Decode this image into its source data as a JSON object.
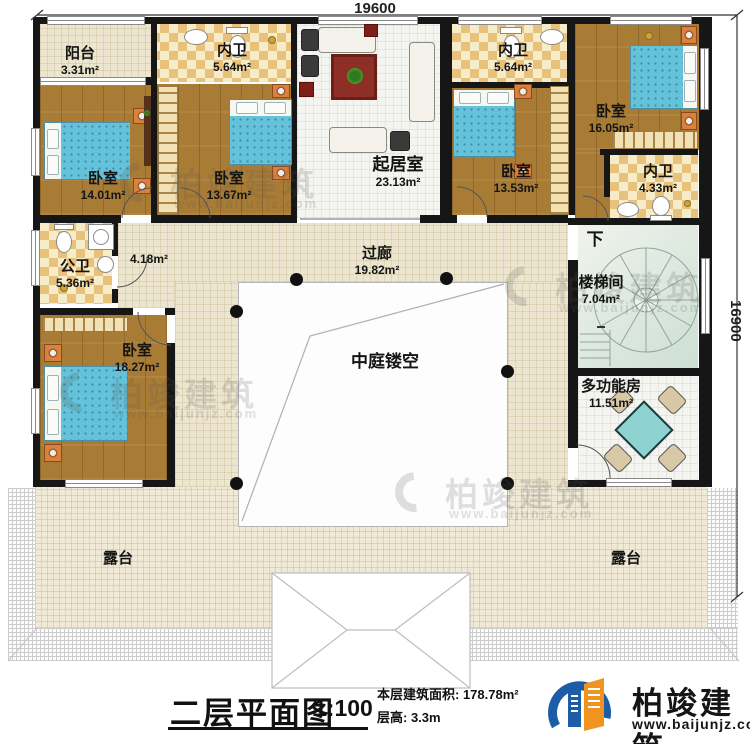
{
  "dimensions": {
    "top": "19600",
    "right": "16900"
  },
  "rooms": [
    {
      "name": "阳台",
      "area": "3.31m²"
    },
    {
      "name": "内卫",
      "area": "5.64m²"
    },
    {
      "name": "起居室",
      "area": "23.13m²"
    },
    {
      "name": "内卫",
      "area": "5.64m²"
    },
    {
      "name": "卧室",
      "area": "16.05m²"
    },
    {
      "name": "卧室",
      "area": "14.01m²"
    },
    {
      "name": "卧室",
      "area": "13.67m²"
    },
    {
      "name": "卧室",
      "area": "13.53m²"
    },
    {
      "name": "内卫",
      "area": "4.33m²"
    },
    {
      "name": "公卫",
      "area": "5.36m²"
    },
    {
      "name": "",
      "area": "4.18m²"
    },
    {
      "name": "过廊",
      "area": "19.82m²"
    },
    {
      "name": "楼梯间",
      "area": "7.04m²"
    },
    {
      "name": "卧室",
      "area": "18.27m²"
    },
    {
      "name": "中庭镂空",
      "area": ""
    },
    {
      "name": "多功能房",
      "area": "11.51m²"
    },
    {
      "name": "露台",
      "area": ""
    },
    {
      "name": "露台",
      "area": ""
    }
  ],
  "stair": {
    "down_label": "下"
  },
  "title": {
    "name": "二层平面图",
    "scale": "1:100",
    "area_line": "本层建筑面积: 178.78m²",
    "height_line": "层高: 3.3m"
  },
  "brand": {
    "name": "柏竣建筑",
    "site": "www.baijunjz.com"
  },
  "watermark": {
    "name": "柏竣建筑",
    "site": "www.baijunjz.com"
  },
  "colors": {
    "wall": "#161616",
    "wood": "#a97c36",
    "corridor": "#ece5cf",
    "terrace": "#efe9d6",
    "bed": "#64c3da",
    "logo_blue": "#1d5ca6",
    "logo_orange": "#f0941f"
  }
}
